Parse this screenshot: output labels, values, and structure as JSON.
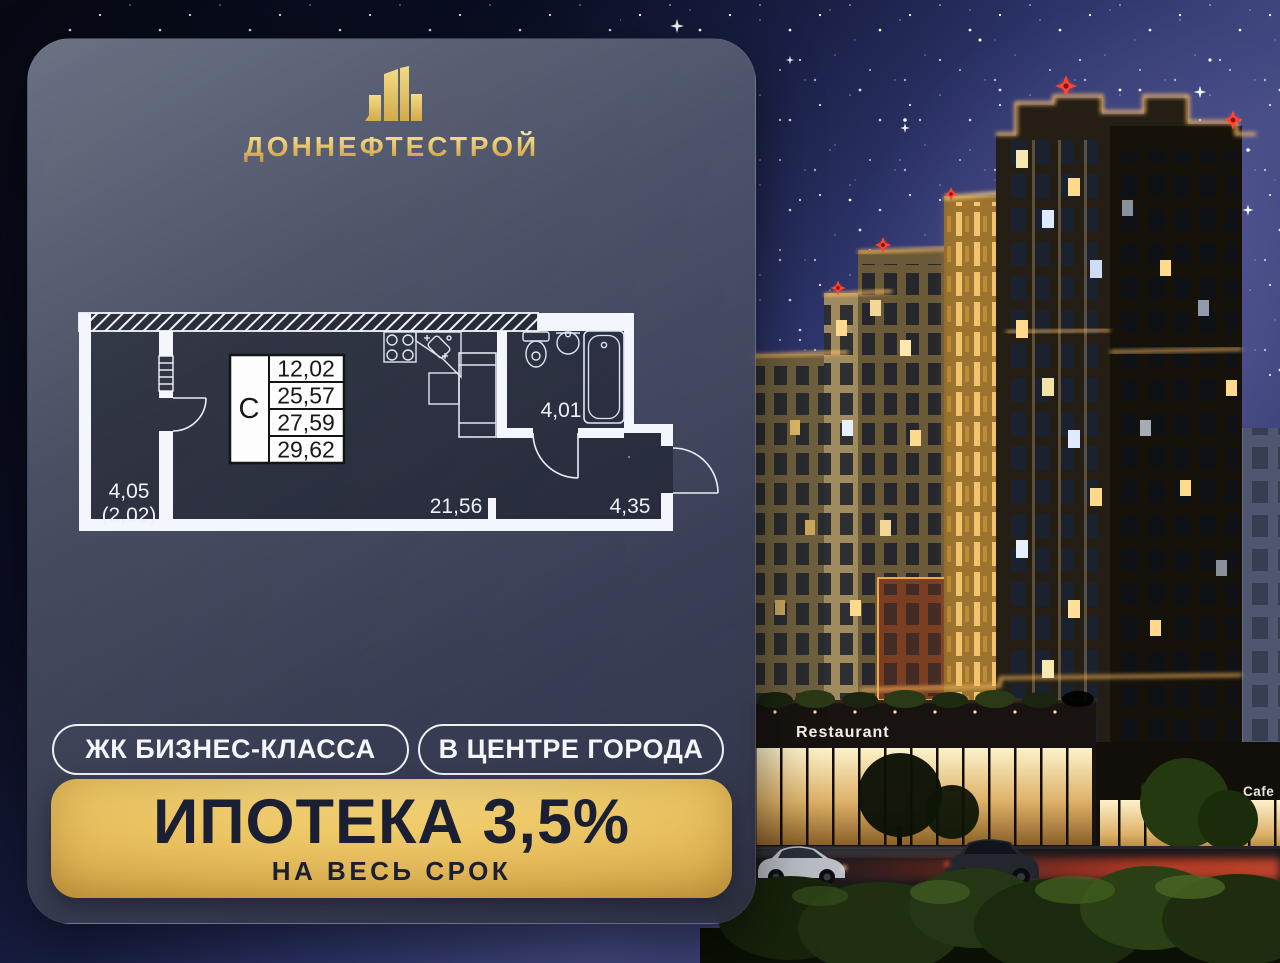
{
  "brand": {
    "name": "ДОННЕФТЕСТРОЙ"
  },
  "floor_plan": {
    "unit_type": "С",
    "area_rows": [
      "12,02",
      "25,57",
      "27,59",
      "29,62"
    ],
    "labels": {
      "balcony_area": "4,05",
      "balcony_reduced": "(2,02)",
      "living_area": "21,56",
      "bathroom_area": "4,01",
      "hall_area": "4,35"
    }
  },
  "badges": [
    {
      "label": "ЖК БИЗНЕС-КЛАССА"
    },
    {
      "label": "В ЦЕНТРЕ ГОРОДА"
    }
  ],
  "banner": {
    "title": "ИПОТЕКА 3,5%",
    "subtitle": "НА ВЕСЬ СРОК"
  },
  "scene": {
    "restaurant_sign": "Restaurant",
    "cafe_sign": "Cafe"
  },
  "colors": {
    "gold_light": "#f6e49c",
    "gold": "#d9ab55",
    "gold_dark": "#a8771f",
    "banner_text": "#1a1f33",
    "dark_navy": "#0a0e22",
    "sky_purple": "#454b85",
    "panel_slate": "#4a5163",
    "window_warm": "#ffd98c",
    "led_amber": "#ffbe5e",
    "red_star": "#ff4431"
  }
}
